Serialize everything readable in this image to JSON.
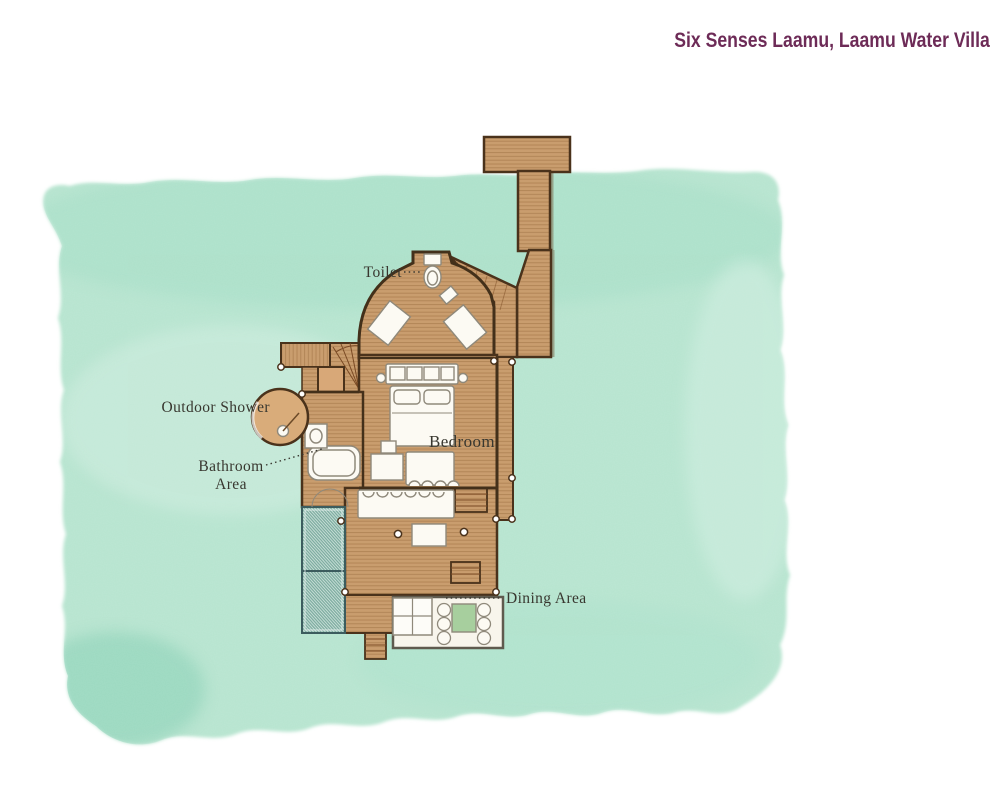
{
  "title": "Six Senses Laamu, Laamu Water Villa",
  "labels": {
    "toilet": "Toilet",
    "outdoor_shower": "Outdoor Shower",
    "bathroom_line1": "Bathroom",
    "bathroom_line2": "Area",
    "bedroom": "Bedroom",
    "dining_area": "Dining Area"
  },
  "colors": {
    "title_text": "#6d2b57",
    "label_text": "#38372f",
    "water_wash": "#b6e4cf",
    "water_dark_patch": "#86cfb4",
    "deck_wood": "#c99d6e",
    "plank_line": "#96683a",
    "wall_outline": "#43301a",
    "net_hatch": "#7cab9f",
    "dining_table_green": "#a7cf9e",
    "fixture_white": "#fcfaf3"
  },
  "rooms_labeled": [
    "Toilet",
    "Outdoor Shower",
    "Bathroom Area",
    "Bedroom",
    "Dining Area"
  ]
}
